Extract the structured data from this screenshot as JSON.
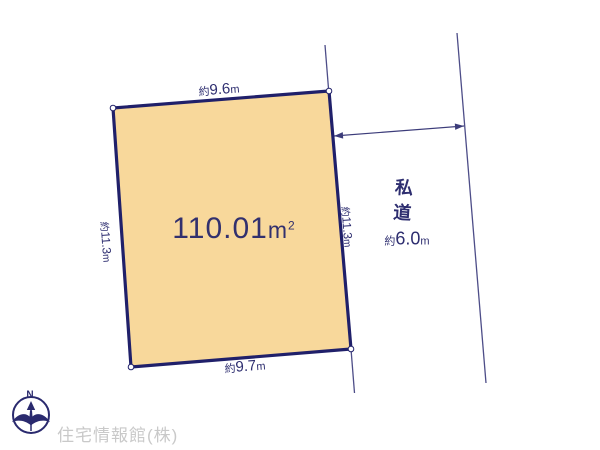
{
  "plot": {
    "area_value": "110.01",
    "area_unit": "m",
    "area_unit_exponent": "2"
  },
  "dimensions": {
    "top": {
      "approx": "約",
      "value": "9.6",
      "unit": "m"
    },
    "bottom": {
      "approx": "約",
      "value": "9.7",
      "unit": "m"
    },
    "left": {
      "approx": "約",
      "value": "11.3",
      "unit": "m"
    },
    "right": {
      "approx": "約",
      "value": "11.3",
      "unit": "m"
    }
  },
  "road": {
    "name": "私道",
    "width": {
      "approx": "約",
      "value": "6.0",
      "unit": "m"
    }
  },
  "compass": {
    "north": "N"
  },
  "footer": {
    "company": "住宅情報館(株)"
  },
  "colors": {
    "plot_fill": "#f8d89b",
    "plot_border": "#20206a",
    "boundary_line": "#4d4d88",
    "arrow_line": "#3c3c7a",
    "text": "#2e2e70",
    "watermark": "#c9c9c9"
  }
}
